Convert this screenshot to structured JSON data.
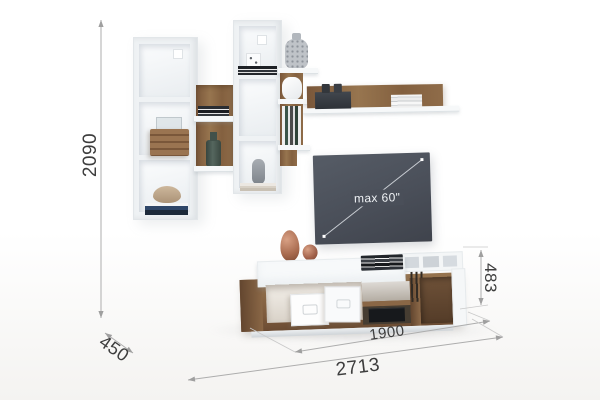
{
  "page": {
    "title": "Wall unit with shelves and TV stand — dimensional product render"
  },
  "annotations": {
    "overall_height": "2090",
    "depth": "450",
    "overall_width": "2713",
    "stand_width": "1900",
    "stand_height": "483",
    "tv_max_size": "max 60\""
  },
  "colors": {
    "background": "#ffffff",
    "wood": "#8a6848",
    "wood_dark": "#6b4e36",
    "white_furniture": "#f5f7f8",
    "tv_panel": "#4a4f59",
    "copper_accent": "#b1765a",
    "dimension_line": "#adadad",
    "dimension_text": "#3d3d3d"
  }
}
